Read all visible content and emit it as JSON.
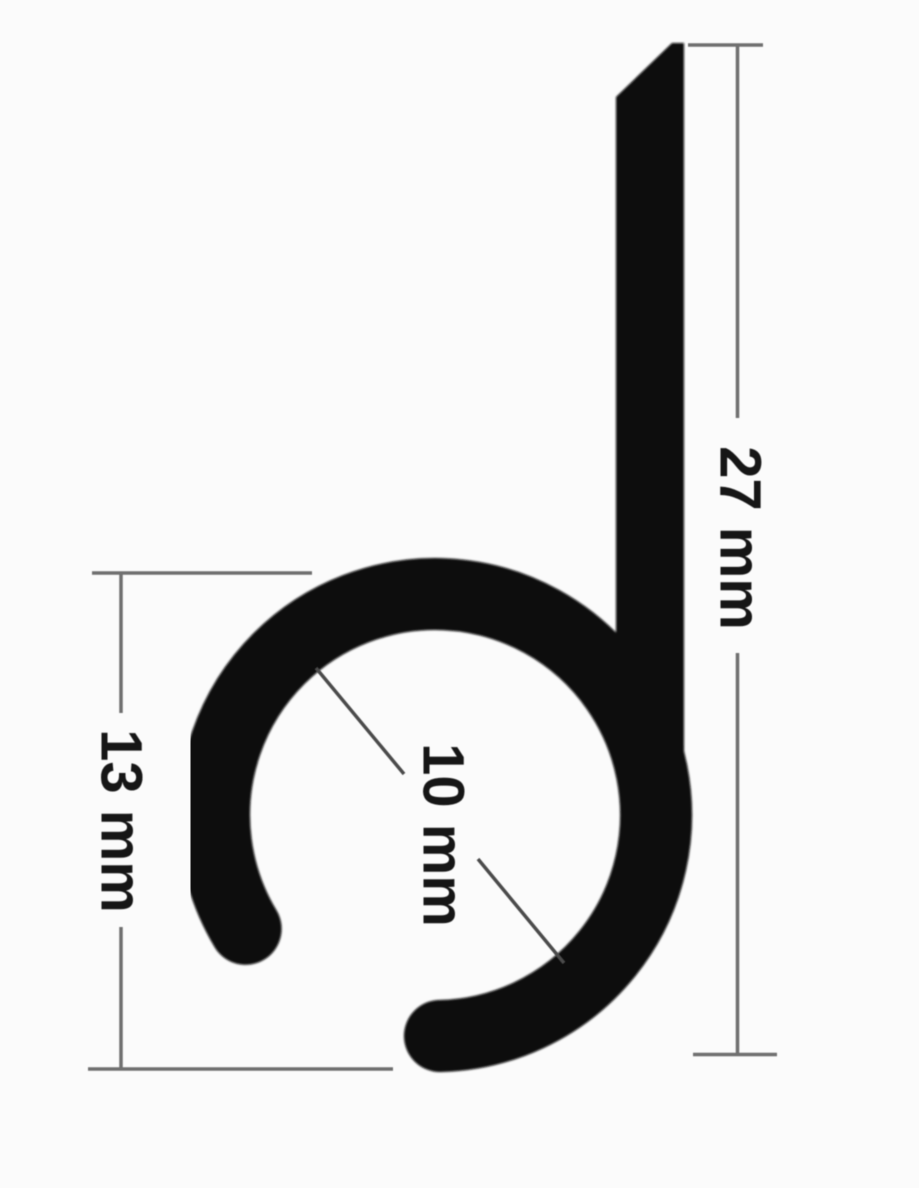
{
  "diagram": {
    "type": "technical-drawing-cross-section",
    "dimensions": [
      {
        "id": "overall-height",
        "label": "27 mm",
        "value": 27,
        "unit": "mm",
        "orientation": "vertical-right"
      },
      {
        "id": "ring-outer-diameter",
        "label": "13 mm",
        "value": 13,
        "unit": "mm",
        "orientation": "vertical-left"
      },
      {
        "id": "ring-inner-diameter",
        "label": "10 mm",
        "value": 10,
        "unit": "mm",
        "orientation": "diagonal-center"
      }
    ],
    "colors": {
      "background": "#fbfbfb",
      "profile": "#070707",
      "dimension_line": "#6f6f6f",
      "leader_line": "#4b4b4b",
      "label_text": "#151515"
    }
  }
}
